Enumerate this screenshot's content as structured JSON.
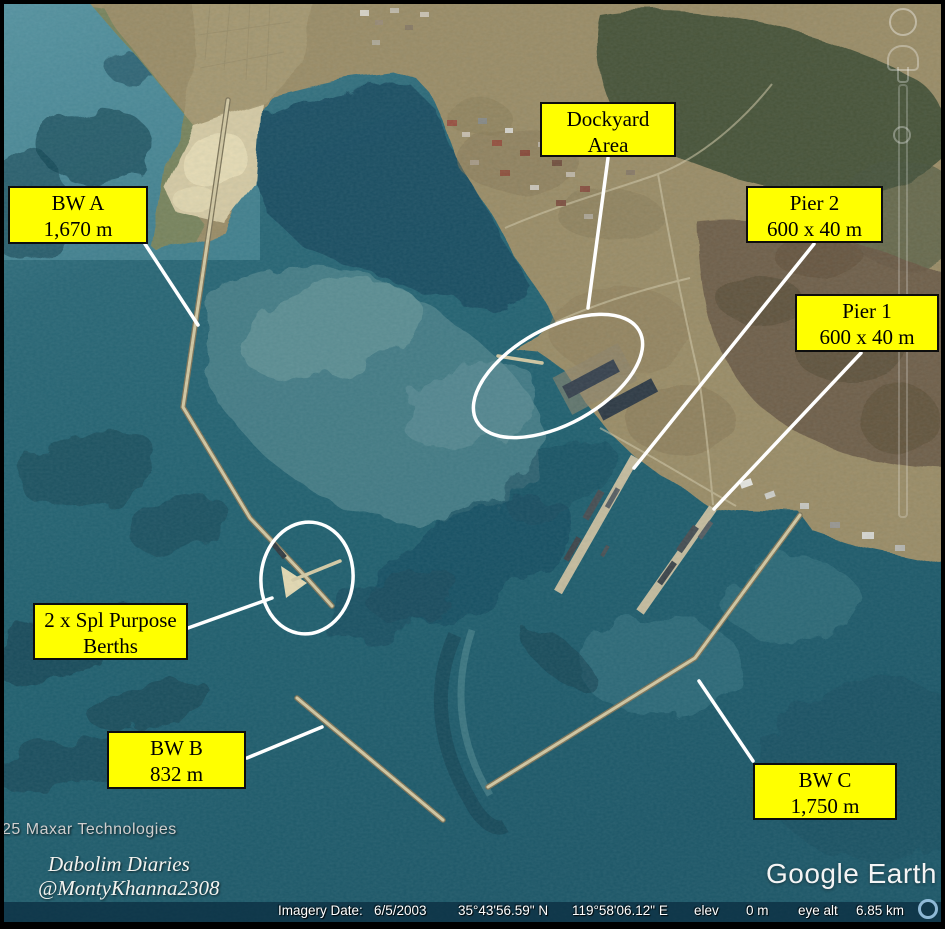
{
  "app": {
    "logo_text": "Google Earth"
  },
  "attribution": {
    "provider": "25 Maxar Technologies",
    "credit_line1": "Dabolim Diaries",
    "credit_line2": "@MontyKhanna2308"
  },
  "annotations": {
    "label_bg_color": "#ffff00",
    "label_border_color": "#0d0d0d",
    "callout_color": "#ffffff",
    "labels": [
      {
        "id": "bw-a",
        "line1": "BW A",
        "line2": "1,670 m"
      },
      {
        "id": "dockyard-area",
        "line1": "Dockyard",
        "line2": "Area"
      },
      {
        "id": "pier-2",
        "line1": "Pier 2",
        "line2": "600 x 40 m"
      },
      {
        "id": "pier-1",
        "line1": "Pier 1",
        "line2": "600 x 40 m"
      },
      {
        "id": "spl-purpose-berths",
        "line1": "2 x Spl Purpose",
        "line2": "Berths"
      },
      {
        "id": "bw-b",
        "line1": "BW B",
        "line2": "832 m"
      },
      {
        "id": "bw-c",
        "line1": "BW C",
        "line2": "1,750 m"
      }
    ]
  },
  "status_bar": {
    "imagery_date_label": "Imagery Date:",
    "imagery_date": "6/5/2003",
    "latitude": "35°43'56.59\" N",
    "longitude": "119°58'06.12\" E",
    "elev_label": "elev",
    "elev_value": "0 m",
    "eye_alt_label": "eye alt",
    "eye_alt_value": "6.85 km"
  }
}
